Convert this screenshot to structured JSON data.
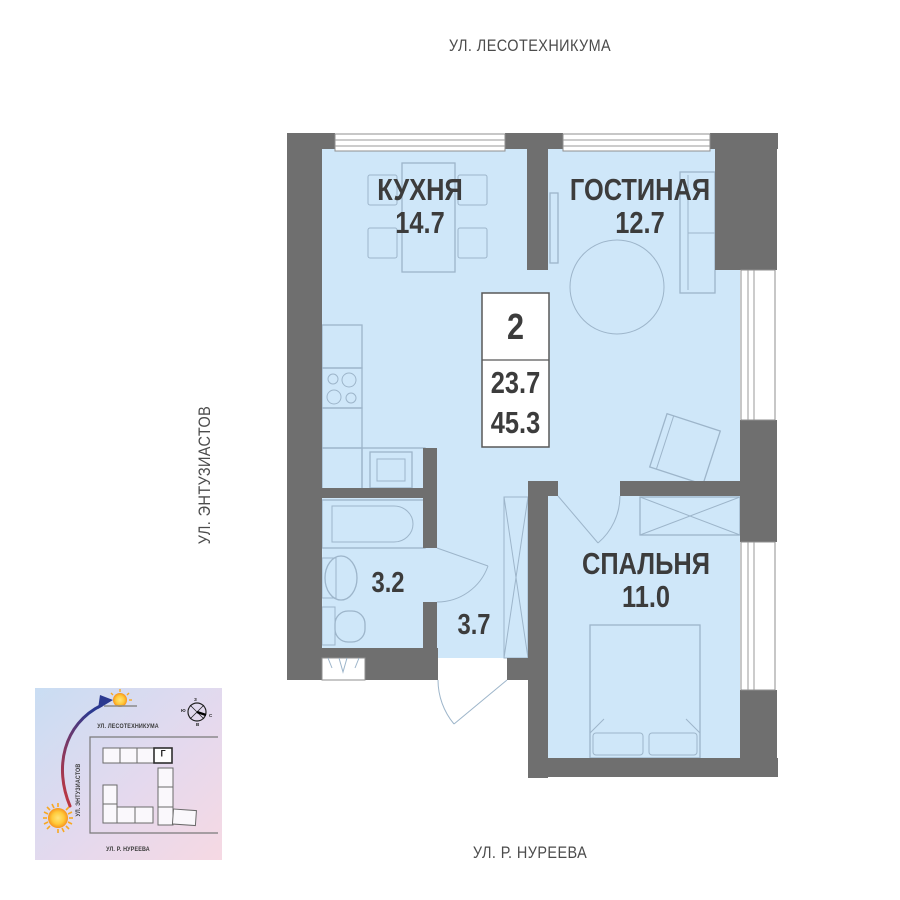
{
  "streets": {
    "top": "УЛ. ЛЕСОТЕХНИКУМА",
    "left": "УЛ. ЭНТУЗИАСТОВ",
    "bottom": "УЛ. Р. НУРЕЕВА"
  },
  "rooms": {
    "kitchen": {
      "name": "КУХНЯ",
      "area": "14.7"
    },
    "living": {
      "name": "ГОСТИНАЯ",
      "area": "12.7"
    },
    "bedroom": {
      "name": "СПАЛЬНЯ",
      "area": "11.0"
    },
    "bathroom": {
      "area": "3.2"
    },
    "hallway": {
      "area": "3.7"
    }
  },
  "info_badge": {
    "rooms": "2",
    "living_area": "23.7",
    "total_area": "45.3"
  },
  "minimap": {
    "streets": {
      "top": "УЛ. ЛЕСОТЕХНИКУМА",
      "left": "УЛ. ЭНТУЗИАСТОВ",
      "bottom": "УЛ. Р. НУРЕЕВА"
    },
    "building_label": "Г",
    "compass": {
      "n": "С",
      "s": "Ю",
      "w": "З",
      "e": "В"
    }
  },
  "colors": {
    "room_fill": "#cfe7f9",
    "wall": "#6f6f6f",
    "furniture_line": "#9db5ca",
    "label_text": "#3c3c3c",
    "minimap_bg_start": "#c9ddf3",
    "minimap_bg_end": "#f6d9e3",
    "sun": "#f7a823",
    "arrow_start": "#c8373c",
    "arrow_end": "#2b3990"
  }
}
